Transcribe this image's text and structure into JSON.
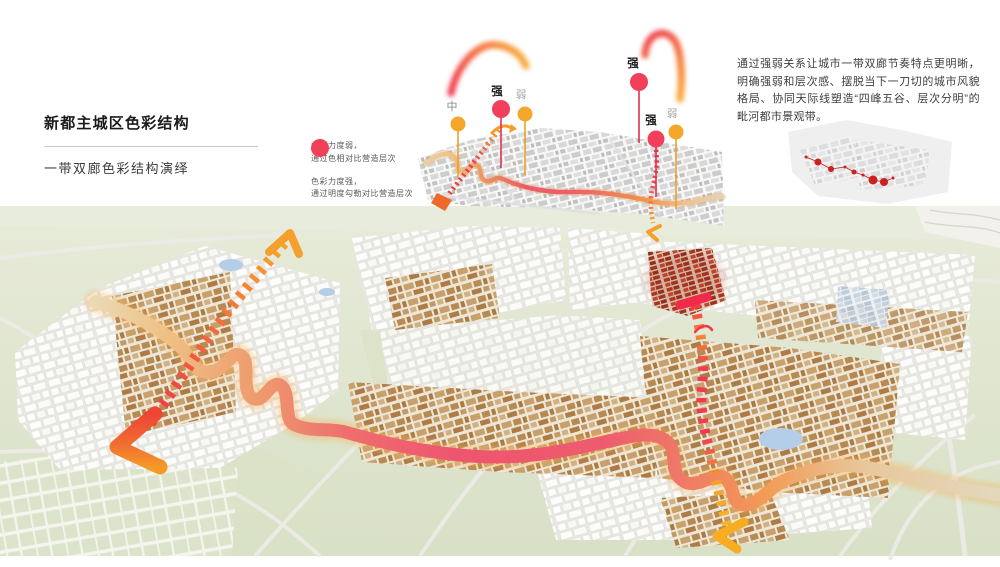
{
  "header": {
    "title": "新都主城区色彩结构",
    "subtitle": "一带双廊色彩结构演绎"
  },
  "legend": {
    "items": [
      {
        "level": "weak",
        "line1": "色彩力度弱，",
        "line2": "通过色相对比营造层次"
      },
      {
        "level": "strong",
        "line1": "色彩力度强，",
        "line2": "通过明度勾勒对比营造层次"
      }
    ]
  },
  "description": {
    "text": "通过强弱关系让城市一带双廊节奏特点更明晰，明确强弱和层次感、摆脱当下一刀切的城市风貌格局、协同天际线塑造“四峰五谷、层次分明”的毗河都市景观带。"
  },
  "minimap": {
    "pins": [
      {
        "label": "中",
        "level": "medium"
      },
      {
        "label": "强",
        "level": "strong"
      },
      {
        "label": "弱",
        "level": "weak"
      },
      {
        "label": "强",
        "level": "strong"
      },
      {
        "label": "强",
        "level": "strong"
      },
      {
        "label": "弱",
        "level": "weak"
      }
    ]
  },
  "colors": {
    "weak": "#F5A72B",
    "strong": "#F23F5A",
    "arc_red": "#EE3344",
    "arc_orange": "#F7A82E",
    "map_green": "#DEE5D0",
    "river_red": "#EE5570",
    "river_orange": "#F29B55",
    "corridor_red": "#F02A48",
    "corridor_orange": "#F58A32",
    "corridor_yellow": "#F7B32C",
    "dark_red_district": "#A83420",
    "pond_blue": "#B4CDE8",
    "tan_building": "#C2996B"
  }
}
